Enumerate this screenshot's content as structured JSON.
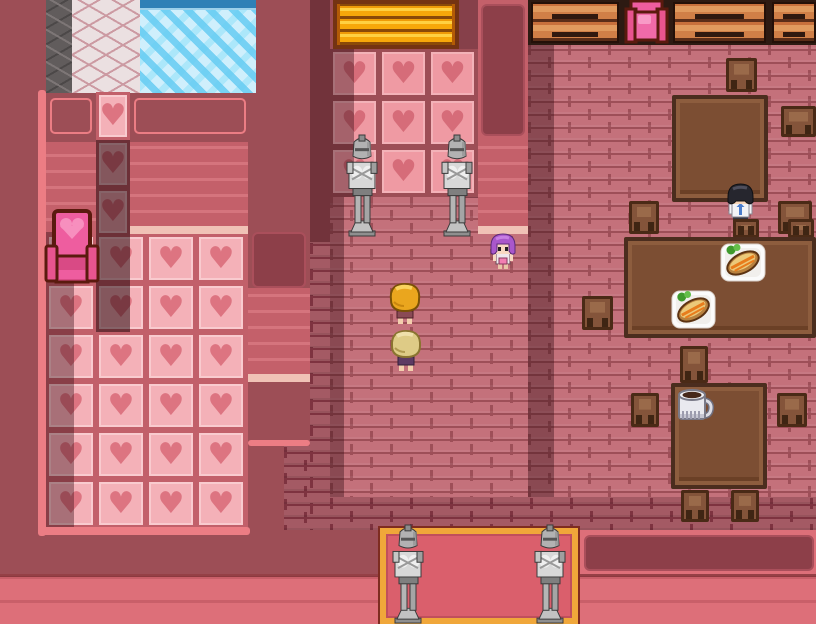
{
  "app": {
    "name": "rpg-valentine-inn-scene",
    "kind": "game-screenshot"
  },
  "palette": {
    "maroon": "#9d4e56",
    "salmon": "#dd6f79",
    "pink-border": "#ec7d84",
    "brick": "#c4717b",
    "mortar": "#9e4f58",
    "water": "#cfeffc",
    "heart-floor": "#f4b1b8",
    "heart-accent": "#dd7481",
    "wood": "#7c4e33",
    "carpet": "#da5f6c",
    "carpet-gold": "#f0a73a",
    "gold-gate": "#f7a80a",
    "statue-gray": "#b2b2b2",
    "throne-pink": "#ee5d9f"
  },
  "scene": {
    "heart_glyph": "♥",
    "parts": [
      {
        "name": "stone-wall-strip",
        "type": "stone",
        "x": 46,
        "y": 0,
        "w": 26,
        "h": 93,
        "interactable": false
      },
      {
        "name": "cobblestone-wall",
        "type": "cobble",
        "x": 72,
        "y": 0,
        "w": 68,
        "h": 93,
        "interactable": false
      },
      {
        "name": "water-pool",
        "type": "water",
        "x": 140,
        "y": 0,
        "w": 116,
        "h": 93,
        "interactable": false
      },
      {
        "name": "pink-border-left",
        "type": "pinkbar",
        "x": 38,
        "y": 90,
        "w": 8,
        "h": 446,
        "interactable": false
      },
      {
        "name": "wall-inset-left",
        "type": "inset",
        "x": 50,
        "y": 98,
        "w": 42,
        "h": 36,
        "interactable": false
      },
      {
        "name": "wall-inset-right",
        "type": "inset",
        "x": 134,
        "y": 98,
        "w": 112,
        "h": 36,
        "interactable": false
      },
      {
        "name": "heart-tile-column",
        "type": "hearts",
        "hearts": "floor",
        "cw": 34,
        "ch": 48,
        "x": 96,
        "y": 92,
        "w": 34,
        "h": 240,
        "interactable": false
      },
      {
        "name": "paneling-wall-left",
        "type": "stripes",
        "x": 46,
        "y": 142,
        "w": 50,
        "h": 92,
        "interactable": false
      },
      {
        "name": "paneling-wall-right",
        "type": "stripes",
        "x": 130,
        "y": 142,
        "w": 118,
        "h": 84,
        "interactable": false
      },
      {
        "name": "cream-trim-left-room",
        "type": "cream",
        "x": 130,
        "y": 226,
        "w": 118,
        "h": 8,
        "interactable": false
      },
      {
        "name": "heart-floor",
        "type": "hearts",
        "hearts": "floor",
        "cw": 50,
        "ch": 49,
        "x": 46,
        "y": 234,
        "w": 202,
        "h": 293,
        "interactable": false
      },
      {
        "name": "pink-border-bottom",
        "type": "pinkbar",
        "x": 38,
        "y": 527,
        "w": 212,
        "h": 8,
        "interactable": false
      },
      {
        "name": "shadow-heart-column",
        "type": "shade2",
        "x": 96,
        "y": 140,
        "w": 34,
        "h": 192,
        "interactable": false
      },
      {
        "name": "shadow-heart-floor",
        "type": "shade",
        "x": 46,
        "y": 232,
        "w": 28,
        "h": 295,
        "interactable": false
      },
      {
        "name": "pink-throne",
        "type": "sprite",
        "sprite": "throne-front",
        "x": 44,
        "y": 208,
        "w": 56,
        "h": 80,
        "interactable": true
      },
      {
        "name": "divider-wall",
        "type": "maroon",
        "x": 248,
        "y": 96,
        "w": 62,
        "h": 290,
        "interactable": false
      },
      {
        "name": "divider-wall-panel",
        "type": "panel",
        "x": 252,
        "y": 232,
        "w": 54,
        "h": 56,
        "interactable": false
      },
      {
        "name": "divider-wall-stripes",
        "type": "stripes",
        "x": 248,
        "y": 288,
        "w": 62,
        "h": 86,
        "interactable": false
      },
      {
        "name": "divider-wall-trim",
        "type": "cream",
        "x": 248,
        "y": 374,
        "w": 62,
        "h": 8,
        "interactable": false
      },
      {
        "name": "divider-wall-base",
        "type": "maroon",
        "x": 248,
        "y": 382,
        "w": 62,
        "h": 62,
        "interactable": false
      },
      {
        "name": "divider-wall-border",
        "type": "pinkbar",
        "x": 248,
        "y": 440,
        "w": 62,
        "h": 6,
        "interactable": false
      },
      {
        "name": "hall-floor-bricks",
        "type": "brick",
        "x": 330,
        "y": 196,
        "w": 198,
        "h": 334,
        "interactable": false
      },
      {
        "name": "hall-floor-shadow-strip",
        "type": "brickdark",
        "x": 310,
        "y": 242,
        "w": 20,
        "h": 288,
        "interactable": false
      },
      {
        "name": "passage-dark-bricks",
        "type": "brickdark",
        "x": 284,
        "y": 446,
        "w": 26,
        "h": 84,
        "interactable": false
      },
      {
        "name": "hall-left-wall-shadow",
        "type": "shade",
        "x": 310,
        "y": 0,
        "w": 20,
        "h": 242,
        "interactable": false
      },
      {
        "name": "hall-floor-edge-shadow",
        "type": "shade",
        "x": 330,
        "y": 196,
        "w": 14,
        "h": 334,
        "interactable": false
      },
      {
        "name": "golden-gate",
        "type": "gate",
        "x": 333,
        "y": 0,
        "w": 126,
        "h": 49,
        "interactable": true
      },
      {
        "name": "gate-side-wall",
        "type": "maroon-dk",
        "x": 459,
        "y": 0,
        "w": 19,
        "h": 198,
        "interactable": false
      },
      {
        "name": "heart-wall",
        "type": "hearts",
        "hearts": "wall",
        "cw": 49,
        "ch": 49,
        "x": 330,
        "y": 49,
        "w": 148,
        "h": 148,
        "interactable": false
      },
      {
        "name": "heart-wall-shadow",
        "type": "shade",
        "x": 330,
        "y": 49,
        "w": 24,
        "h": 148,
        "interactable": false
      },
      {
        "name": "right-wall-column",
        "type": "salmoncol",
        "x": 478,
        "y": 0,
        "w": 50,
        "h": 234,
        "interactable": false
      },
      {
        "name": "right-wall-panel",
        "type": "panel",
        "x": 481,
        "y": 4,
        "w": 44,
        "h": 132,
        "interactable": false
      },
      {
        "name": "right-wall-stripes",
        "type": "stripes",
        "x": 478,
        "y": 136,
        "w": 50,
        "h": 90,
        "interactable": false
      },
      {
        "name": "right-wall-trim",
        "type": "cream",
        "x": 478,
        "y": 226,
        "w": 50,
        "h": 8,
        "interactable": false
      },
      {
        "name": "knight-statue-left",
        "type": "sprite",
        "sprite": "statue",
        "x": 343,
        "y": 134,
        "w": 38,
        "h": 103,
        "interactable": false
      },
      {
        "name": "knight-statue-right",
        "type": "sprite",
        "sprite": "statue",
        "x": 438,
        "y": 134,
        "w": 38,
        "h": 103,
        "interactable": false
      },
      {
        "name": "dining-floor-bricks",
        "type": "brick",
        "x": 528,
        "y": 43,
        "w": 288,
        "h": 487,
        "interactable": false
      },
      {
        "name": "dining-wall-shadow",
        "type": "shade",
        "x": 528,
        "y": 43,
        "w": 26,
        "h": 487,
        "interactable": false
      },
      {
        "name": "south-wall-bricks",
        "type": "brickdark",
        "x": 330,
        "y": 497,
        "w": 486,
        "h": 33,
        "interactable": false
      },
      {
        "name": "bench-row-backwall",
        "type": "benchrow",
        "x": 528,
        "y": 0,
        "w": 288,
        "h": 45,
        "interactable": false
      },
      {
        "name": "wooden-bench-1",
        "type": "bench",
        "x": 531,
        "y": 2,
        "w": 88,
        "h": 41,
        "interactable": false
      },
      {
        "name": "wooden-bench-2",
        "type": "bench",
        "x": 673,
        "y": 2,
        "w": 93,
        "h": 41,
        "interactable": false
      },
      {
        "name": "wooden-bench-3",
        "type": "bench",
        "x": 772,
        "y": 2,
        "w": 44,
        "h": 41,
        "interactable": false
      },
      {
        "name": "pink-throne-top",
        "type": "sprite",
        "sprite": "throne-top",
        "x": 621,
        "y": 0,
        "w": 51,
        "h": 46,
        "interactable": true
      },
      {
        "name": "chair-north-of-table1",
        "type": "chair",
        "x": 726,
        "y": 58,
        "w": 31,
        "h": 34,
        "interactable": false
      },
      {
        "name": "dining-table-1",
        "type": "table",
        "x": 672,
        "y": 95,
        "w": 96,
        "h": 107,
        "interactable": false
      },
      {
        "name": "chair-east-of-table1",
        "type": "chair",
        "x": 781,
        "y": 106,
        "w": 35,
        "h": 31,
        "interactable": false
      },
      {
        "name": "chair-sw-of-table1",
        "type": "chair",
        "x": 629,
        "y": 201,
        "w": 30,
        "h": 33,
        "interactable": false
      },
      {
        "name": "chair-se-of-table1",
        "type": "chair",
        "x": 778,
        "y": 201,
        "w": 34,
        "h": 33,
        "interactable": false
      },
      {
        "name": "npc-black-haired-boy",
        "type": "sprite",
        "sprite": "boy",
        "x": 724,
        "y": 181,
        "w": 33,
        "h": 51,
        "interactable": true
      },
      {
        "name": "chair-top-behind-table2-a",
        "type": "chair",
        "x": 733,
        "y": 219,
        "w": 26,
        "h": 19,
        "interactable": false
      },
      {
        "name": "chair-top-behind-table2-b",
        "type": "chair",
        "x": 788,
        "y": 219,
        "w": 26,
        "h": 19,
        "interactable": false
      },
      {
        "name": "dining-table-2",
        "type": "table",
        "x": 624,
        "y": 237,
        "w": 192,
        "h": 101,
        "interactable": false
      },
      {
        "name": "food-plate-1",
        "type": "sprite",
        "sprite": "plate",
        "x": 718,
        "y": 241,
        "w": 50,
        "h": 43,
        "interactable": false
      },
      {
        "name": "food-plate-2",
        "type": "sprite",
        "sprite": "plate",
        "x": 669,
        "y": 288,
        "w": 49,
        "h": 43,
        "interactable": false
      },
      {
        "name": "chair-west-of-table2",
        "type": "chair",
        "x": 582,
        "y": 296,
        "w": 31,
        "h": 34,
        "interactable": false
      },
      {
        "name": "chair-south-of-table2",
        "type": "chair",
        "x": 680,
        "y": 346,
        "w": 28,
        "h": 37,
        "interactable": false
      },
      {
        "name": "dining-table-3",
        "type": "table",
        "x": 671,
        "y": 383,
        "w": 96,
        "h": 106,
        "interactable": false
      },
      {
        "name": "water-pitcher",
        "type": "sprite",
        "sprite": "pitcher",
        "x": 674,
        "y": 385,
        "w": 41,
        "h": 39,
        "interactable": false
      },
      {
        "name": "chair-west-of-table3",
        "type": "chair",
        "x": 631,
        "y": 393,
        "w": 28,
        "h": 34,
        "interactable": false
      },
      {
        "name": "chair-east-of-table3",
        "type": "chair",
        "x": 777,
        "y": 393,
        "w": 30,
        "h": 34,
        "interactable": false
      },
      {
        "name": "chair-south-of-table3-a",
        "type": "chair",
        "x": 681,
        "y": 490,
        "w": 28,
        "h": 32,
        "interactable": false
      },
      {
        "name": "chair-south-of-table3-b",
        "type": "chair",
        "x": 731,
        "y": 490,
        "w": 28,
        "h": 32,
        "interactable": false
      },
      {
        "name": "npc-purple-haired-girl",
        "type": "sprite",
        "sprite": "girl",
        "x": 487,
        "y": 232,
        "w": 32,
        "h": 40,
        "interactable": true
      },
      {
        "name": "npc-blonde-kid",
        "type": "sprite",
        "sprite": "blonde",
        "x": 386,
        "y": 280,
        "w": 38,
        "h": 46,
        "interactable": true
      },
      {
        "name": "npc-tan-haired-kid",
        "type": "sprite",
        "sprite": "tankid",
        "x": 388,
        "y": 327,
        "w": 36,
        "h": 46,
        "interactable": true
      },
      {
        "name": "south-wall-salmon-right",
        "type": "salmon",
        "x": 578,
        "y": 530,
        "w": 238,
        "h": 94,
        "interactable": false
      },
      {
        "name": "south-wall-panel-right",
        "type": "panel",
        "x": 584,
        "y": 535,
        "w": 230,
        "h": 36,
        "interactable": false
      },
      {
        "name": "south-wainscot-right",
        "type": "salmon-stripes topline",
        "x": 578,
        "y": 574,
        "w": 238,
        "h": 50,
        "interactable": false
      },
      {
        "name": "south-wainscot-left",
        "type": "salmon-stripes topline",
        "x": 0,
        "y": 574,
        "w": 380,
        "h": 50,
        "interactable": false
      },
      {
        "name": "entrance-carpet",
        "type": "carpet",
        "x": 380,
        "y": 528,
        "w": 198,
        "h": 96,
        "interactable": true
      },
      {
        "name": "knight-statue-entrance-left",
        "type": "sprite",
        "sprite": "statue",
        "x": 389,
        "y": 524,
        "w": 38,
        "h": 100,
        "interactable": false
      },
      {
        "name": "knight-statue-entrance-right",
        "type": "sprite",
        "sprite": "statue",
        "x": 531,
        "y": 524,
        "w": 38,
        "h": 100,
        "interactable": false
      }
    ]
  }
}
